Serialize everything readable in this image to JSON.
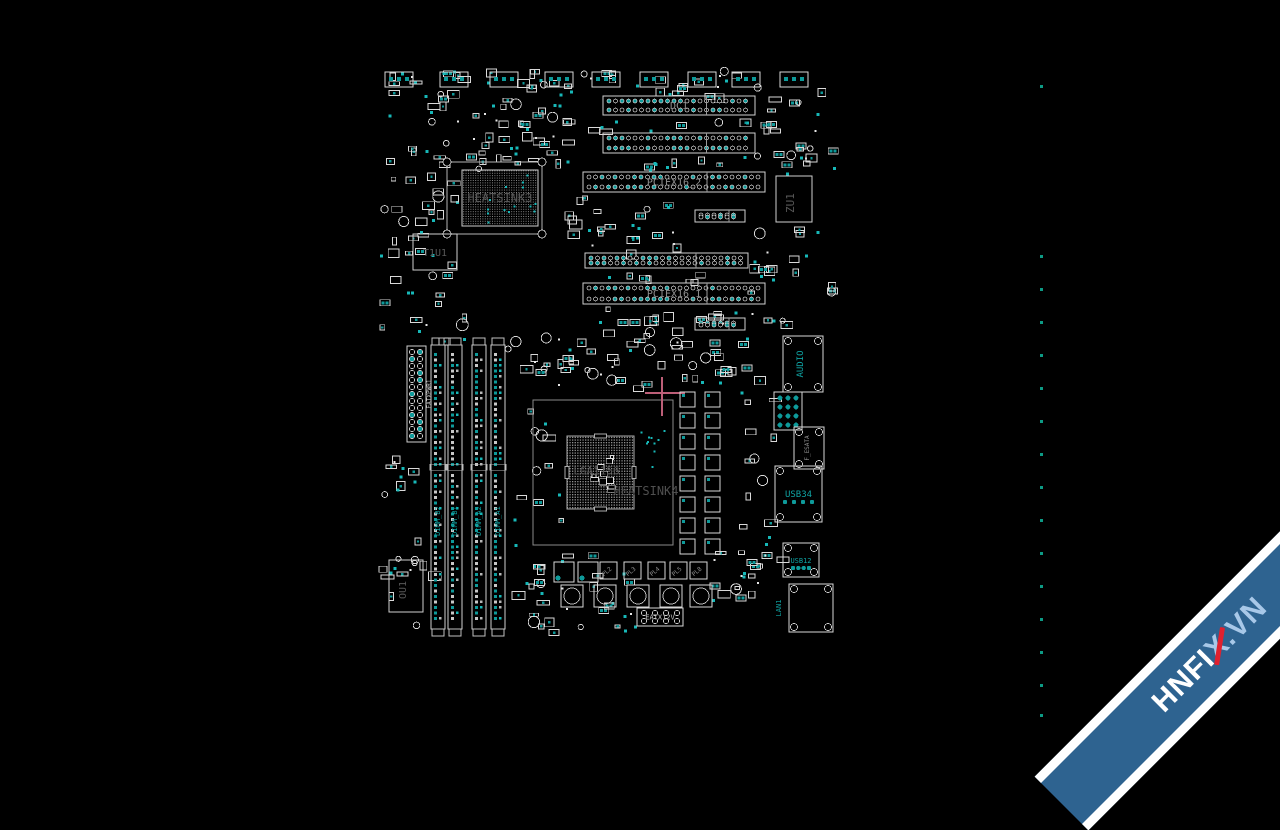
{
  "canvas": {
    "w": 1280,
    "h": 720,
    "bg": "#000000"
  },
  "palette": {
    "outline": "#d9d9d9",
    "outline_dim": "#9a9a9a",
    "pad": "#0e9a9a",
    "pad_bright": "#17b8b8",
    "chip_text": "#585858",
    "slot_text": "#8f8f8f",
    "white_text": "#bdbdbd",
    "teal_text": "#0fa3a3",
    "crosshair": "#bd5f78",
    "dot_column_color": "#0d9a85",
    "socket_dot": "#909090"
  },
  "top_headers": {
    "y": 72,
    "h": 15,
    "w": 28,
    "xs": [
      385,
      440,
      490,
      545,
      592,
      640,
      688,
      732,
      780
    ]
  },
  "slots": [
    {
      "id": "dc1",
      "label": "DC1",
      "x": 603,
      "y": 96,
      "w": 152,
      "h": 19
    },
    {
      "id": "slot-b",
      "label": "",
      "x": 603,
      "y": 133,
      "w": 152,
      "h": 20
    },
    {
      "id": "pciex16-2",
      "label": "PCIEX16_2",
      "x": 583,
      "y": 172,
      "w": 182,
      "h": 20
    },
    {
      "id": "slot-mid",
      "label": "",
      "x": 585,
      "y": 253,
      "w": 163,
      "h": 15
    },
    {
      "id": "pciex16-1",
      "label": "PCIEX16_1",
      "x": 583,
      "y": 283,
      "w": 182,
      "h": 21
    },
    {
      "id": "short-1",
      "label": "",
      "x": 695,
      "y": 210,
      "w": 50,
      "h": 12
    },
    {
      "id": "short-2",
      "label": "",
      "x": 695,
      "y": 318,
      "w": 50,
      "h": 12
    }
  ],
  "dimms": {
    "y": 345,
    "h": 284,
    "w": 14,
    "xs": [
      431,
      448,
      472,
      491
    ],
    "labels": [
      "DIMM_B2",
      "DIMM_B1",
      "DIMM_A2",
      "DIMM_A1"
    ]
  },
  "atx": {
    "id": "eatxpwr1",
    "label": "EATXPWR1",
    "x": 407,
    "y": 346,
    "w": 19,
    "h": 96
  },
  "cpu": {
    "keepout": {
      "x": 533,
      "y": 400,
      "w": 140,
      "h": 145
    },
    "socket": {
      "x": 567,
      "y": 436,
      "w": 67,
      "h": 73
    },
    "label": "LGA1156",
    "heatsink_label": "HEATSINK4",
    "crosshair": {
      "x": 662,
      "y": 393
    }
  },
  "chips": [
    {
      "id": "heatsink3",
      "label": "HEATSINK3",
      "x": 462,
      "y": 170,
      "w": 76,
      "h": 56,
      "keepout": {
        "x": 447,
        "y": 162,
        "w": 95,
        "h": 72
      },
      "bga": true,
      "label_size": 12
    },
    {
      "id": "t1u1",
      "label": "T1U1",
      "x": 413,
      "y": 234,
      "w": 44,
      "h": 36,
      "label_size": 10
    },
    {
      "id": "zu1",
      "label": "ZU1",
      "x": 776,
      "y": 176,
      "w": 36,
      "h": 46,
      "rot": true,
      "label_size": 11
    },
    {
      "id": "ou1",
      "label": "OU1",
      "x": 389,
      "y": 560,
      "w": 34,
      "h": 52,
      "rot": true,
      "label_size": 10
    }
  ],
  "vrm": {
    "x": 680,
    "y": 392,
    "cols": 2,
    "rows": 8,
    "dx": 25,
    "dy": 21,
    "size": 15
  },
  "power": {
    "big_squares": [
      {
        "x": 554,
        "y": 562
      },
      {
        "x": 578,
        "y": 562
      }
    ],
    "big_size": 20,
    "mosfets": [
      {
        "label": "PL2",
        "x": 600
      },
      {
        "label": "PL3",
        "x": 624
      },
      {
        "label": "PL4",
        "x": 648
      },
      {
        "label": "PL5",
        "x": 670
      },
      {
        "label": "PL8",
        "x": 690
      }
    ],
    "mosfet_y": 562,
    "mosfet_size": 17,
    "chokes": [
      561,
      594,
      627,
      660,
      690
    ],
    "choke_y": 585,
    "choke_size": 22,
    "eatx12v": {
      "label": "EATX12V",
      "x": 637,
      "y": 608,
      "w": 46,
      "h": 18
    }
  },
  "right_io": [
    {
      "id": "audio",
      "label": "AUDIO",
      "x": 783,
      "y": 336,
      "w": 40,
      "h": 56,
      "rot": true,
      "color": "teal_text",
      "label_size": 9,
      "pads": "corner"
    },
    {
      "id": "audio-jacks",
      "label": "",
      "x": 774,
      "y": 392,
      "w": 28,
      "h": 38,
      "jack_grid": true
    },
    {
      "id": "f-esata",
      "label": "F_ESATA",
      "x": 794,
      "y": 427,
      "w": 30,
      "h": 42,
      "rot": true,
      "color": "slot_text",
      "label_size": 6,
      "pads": "corner"
    },
    {
      "id": "usb34",
      "label": "USB34",
      "x": 775,
      "y": 466,
      "w": 47,
      "h": 56,
      "color": "teal_text",
      "label_size": 9,
      "pads": "usb"
    },
    {
      "id": "usb12",
      "label": "USB12",
      "x": 783,
      "y": 543,
      "w": 36,
      "h": 34,
      "color": "teal_text",
      "label_size": 7,
      "pads": "usb"
    },
    {
      "id": "lan1",
      "label": "LAN1",
      "x": 789,
      "y": 584,
      "w": 44,
      "h": 48,
      "color": "teal_text",
      "label_size": 7,
      "label_outside": true,
      "pads": "corner"
    }
  ],
  "dot_column": {
    "x": 1040,
    "size": 3,
    "ys": [
      85,
      255,
      288,
      321,
      354,
      387,
      420,
      453,
      486,
      519,
      552,
      585,
      618,
      651,
      684,
      714
    ]
  },
  "scatter_fields": [
    {
      "x": 380,
      "y": 68,
      "w": 185,
      "h": 95,
      "n": 60,
      "seed": 11
    },
    {
      "x": 470,
      "y": 115,
      "w": 95,
      "h": 55,
      "n": 22,
      "seed": 22
    },
    {
      "x": 378,
      "y": 168,
      "w": 88,
      "h": 175,
      "n": 42,
      "seed": 33
    },
    {
      "x": 560,
      "y": 70,
      "w": 195,
      "h": 24,
      "n": 22,
      "seed": 44
    },
    {
      "x": 565,
      "y": 117,
      "w": 190,
      "h": 13,
      "n": 9,
      "seed": 55
    },
    {
      "x": 565,
      "y": 156,
      "w": 195,
      "h": 13,
      "n": 10,
      "seed": 66
    },
    {
      "x": 565,
      "y": 196,
      "w": 125,
      "h": 55,
      "n": 26,
      "seed": 77
    },
    {
      "x": 565,
      "y": 272,
      "w": 195,
      "h": 9,
      "n": 7,
      "seed": 88
    },
    {
      "x": 560,
      "y": 307,
      "w": 200,
      "h": 22,
      "n": 16,
      "seed": 99
    },
    {
      "x": 558,
      "y": 330,
      "w": 125,
      "h": 58,
      "n": 34,
      "seed": 111
    },
    {
      "x": 690,
      "y": 333,
      "w": 70,
      "h": 50,
      "n": 16,
      "seed": 122
    },
    {
      "x": 755,
      "y": 68,
      "w": 78,
      "h": 105,
      "n": 26,
      "seed": 133
    },
    {
      "x": 748,
      "y": 225,
      "w": 84,
      "h": 108,
      "n": 24,
      "seed": 144
    },
    {
      "x": 508,
      "y": 335,
      "w": 52,
      "h": 290,
      "n": 30,
      "seed": 155
    },
    {
      "x": 378,
      "y": 448,
      "w": 52,
      "h": 180,
      "n": 24,
      "seed": 166
    },
    {
      "x": 525,
      "y": 545,
      "w": 110,
      "h": 85,
      "n": 26,
      "seed": 177
    },
    {
      "x": 700,
      "y": 545,
      "w": 80,
      "h": 55,
      "n": 18,
      "seed": 188
    },
    {
      "x": 736,
      "y": 385,
      "w": 36,
      "h": 175,
      "n": 16,
      "seed": 199
    }
  ],
  "watermark": {
    "parts": [
      {
        "t": "HNFI",
        "color": "#ffffff",
        "slash": false
      },
      {
        "t": "X",
        "color": "#a8c8e8",
        "slash": true
      },
      {
        "t": ".VN",
        "color": "#a8c8e8",
        "slash": false
      }
    ],
    "band_color": "#2e6390",
    "edge_color": "#ffffff",
    "slash_color": "#e0212f"
  }
}
